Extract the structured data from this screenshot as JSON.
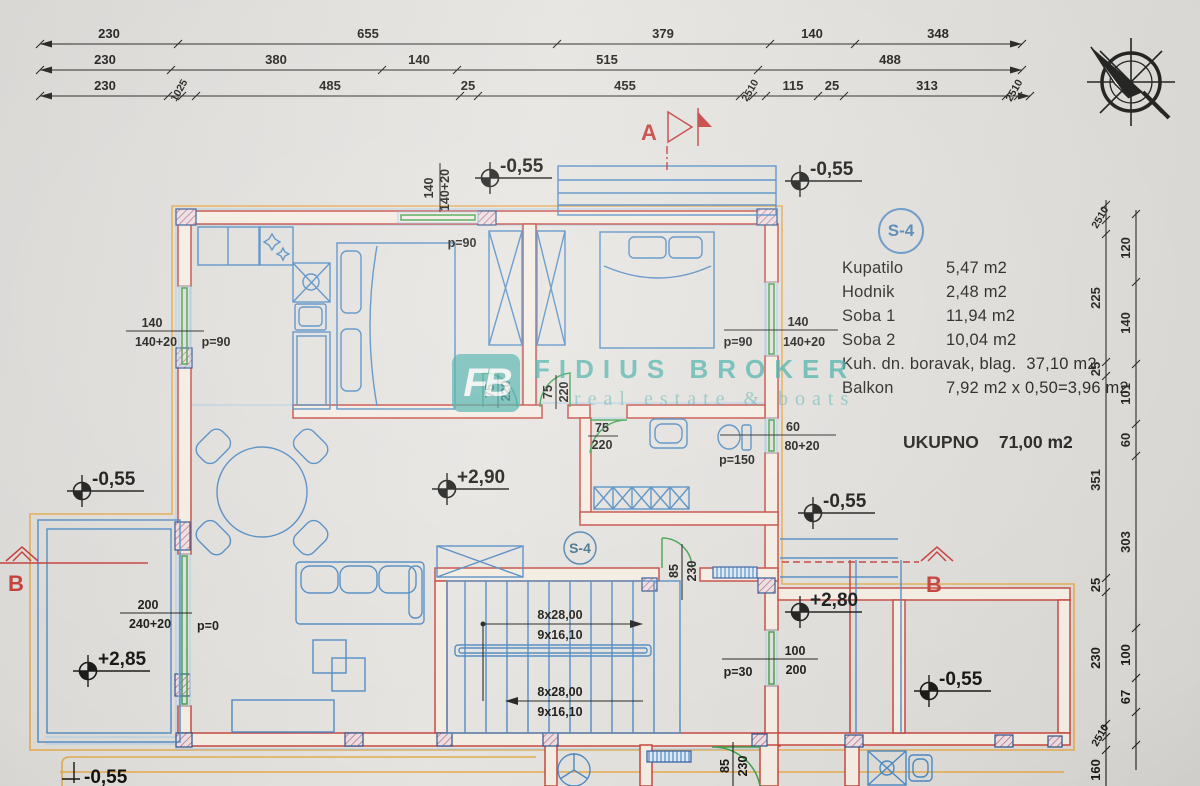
{
  "watermark": {
    "logo": "FB",
    "title": "FIDIUS BROKER",
    "subtitle": "real estate & boats"
  },
  "badge": {
    "plan": "S-4",
    "legend": "S-4"
  },
  "sections": {
    "a": "A",
    "b_left": "B",
    "b_right": "B"
  },
  "legend": {
    "rows": [
      {
        "name": "Kupatilo",
        "value": "5,47 m2"
      },
      {
        "name": "Hodnik",
        "value": "2,48 m2"
      },
      {
        "name": "Soba 1",
        "value": "11,94 m2"
      },
      {
        "name": "Soba 2",
        "value": "10,04 m2"
      },
      {
        "name": "Kuh. dn. boravak, blag.",
        "value": "37,10 m2"
      },
      {
        "name": "Balkon",
        "value": "7,92 m2 x 0,50=3,96 m2"
      }
    ],
    "total_name": "UKUPNO",
    "total_value": "71,00 m2"
  },
  "elev": {
    "e1": "-0,55",
    "e2": "-0,55",
    "e3": "-0,55",
    "e4": "+2,90",
    "e5": "-0,55",
    "e6": "+2,85",
    "e7": "+2,80",
    "e8": "-0,55",
    "e9": "-0,55"
  },
  "dims": {
    "t1": [
      "230",
      "655",
      "379",
      "140",
      "348"
    ],
    "t2": [
      "230",
      "380",
      "140",
      "515",
      "488"
    ],
    "t3": [
      "230",
      "1025",
      "485",
      "25",
      "455",
      "2510",
      "115",
      "25",
      "313",
      "2510"
    ],
    "ro": [
      "2510",
      "225",
      "25",
      "351",
      "25",
      "230",
      "2510",
      "160"
    ],
    "ri": [
      "120",
      "140",
      "101",
      "60",
      "303",
      "100",
      "67"
    ]
  },
  "open": {
    "w1": {
      "a": "140",
      "b": "140+20",
      "p": "p=90"
    },
    "w2": {
      "a": "140",
      "b": "140+20",
      "p": "p=90"
    },
    "w3": {
      "a": "140",
      "b": "140+20",
      "p": "p=90"
    },
    "w4": {
      "a": "60",
      "b": "80+20",
      "p": "p=150"
    },
    "w5": {
      "a": "100",
      "b": "200",
      "p": "p=30"
    },
    "w6": {
      "a": "200",
      "b": "240+20",
      "p": "p=0"
    },
    "d1": {
      "a": "75",
      "b": "220"
    },
    "d2": {
      "a": "75",
      "b": "220"
    },
    "d3": {
      "a": "75",
      "b": "220"
    },
    "d4": {
      "a": "85",
      "b": "230"
    },
    "d5": {
      "a": "85",
      "b": "230"
    }
  },
  "stairs": {
    "a": "8x28,00",
    "b": "9x16,10"
  },
  "colors": {
    "wall": "#c4453c",
    "furniture": "#4b87c0",
    "window": "#3f9e49",
    "outline": "#e2a94e",
    "watermark": "#3aa8a2",
    "section": "#c23a36",
    "legend_circle": "#5c8fc2",
    "dim": "#1f1e1c"
  }
}
